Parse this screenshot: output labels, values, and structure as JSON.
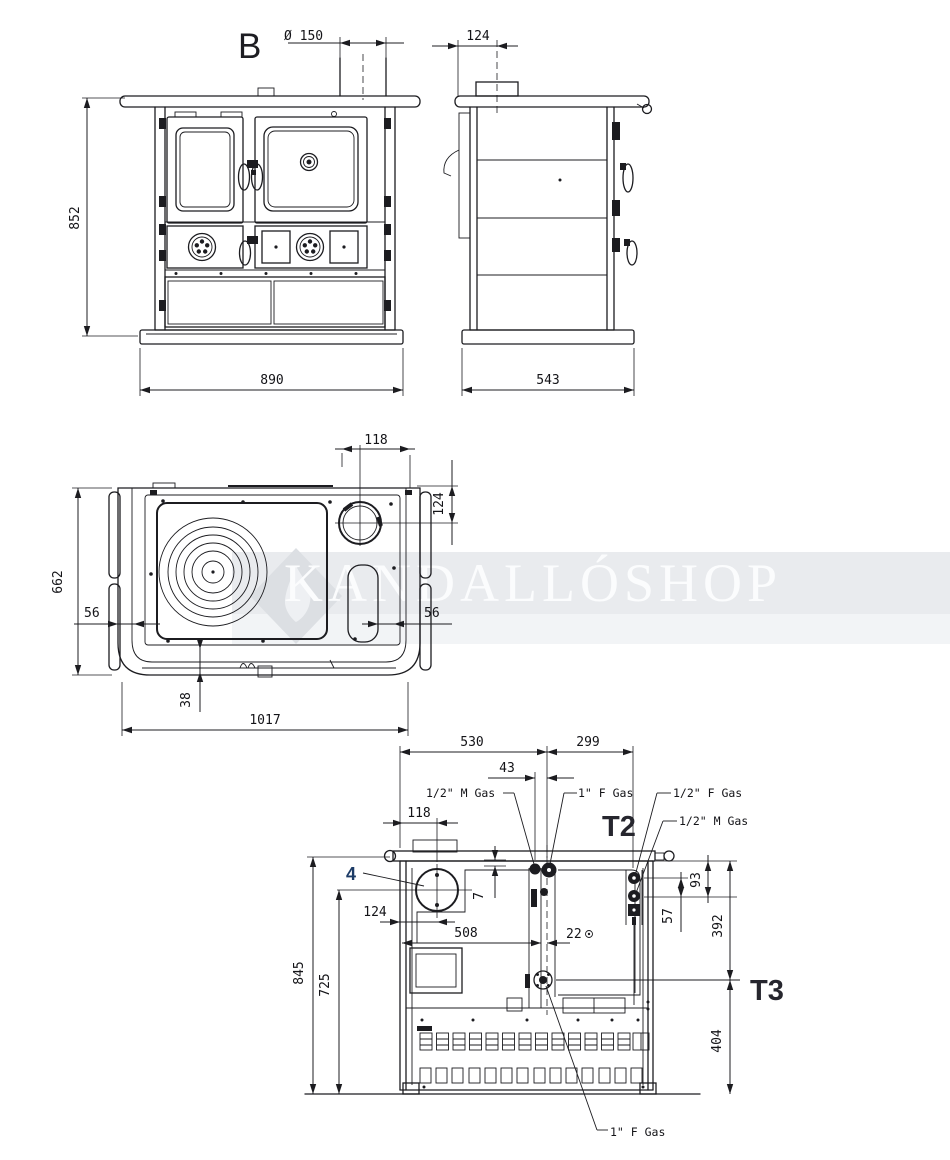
{
  "watermark": {
    "text": "KANDALLÓSHOP"
  },
  "front_view": {
    "section_label": "B",
    "dim_flue_diameter": "Ø 150",
    "dim_height": "852",
    "dim_width": "890"
  },
  "side_view": {
    "dim_flue_offset": "124",
    "dim_depth": "543"
  },
  "top_view": {
    "dim_flue_from_plate": "118",
    "dim_flue_from_back": "124",
    "dim_depth": "662",
    "dim_left_inset": "56",
    "dim_right_inset": "56",
    "dim_front_rail": "38",
    "dim_width": "1017"
  },
  "rear_view": {
    "dim_width_left": "530",
    "dim_width_right": "299",
    "dim_center_offset": "43",
    "label_gas_m_top": "1/2\" M Gas",
    "label_gas_f_top": "1\" F Gas",
    "label_t2": "T2",
    "label_gas_f_right": "1/2\" F Gas",
    "label_gas_m_right": "1/2\" M Gas",
    "dim_flue_from_edge": "118",
    "callout_flue": "4",
    "dim_gap": "7",
    "dim_flue_left": "124",
    "dim_span": "508",
    "dim_offset22": "22",
    "dim_h93": "93",
    "dim_h57": "57",
    "dim_h392": "392",
    "dim_height_total": "845",
    "dim_height_flue": "725",
    "label_t3": "T3",
    "dim_h404": "404",
    "label_gas_f_bottom": "1\" F Gas"
  }
}
